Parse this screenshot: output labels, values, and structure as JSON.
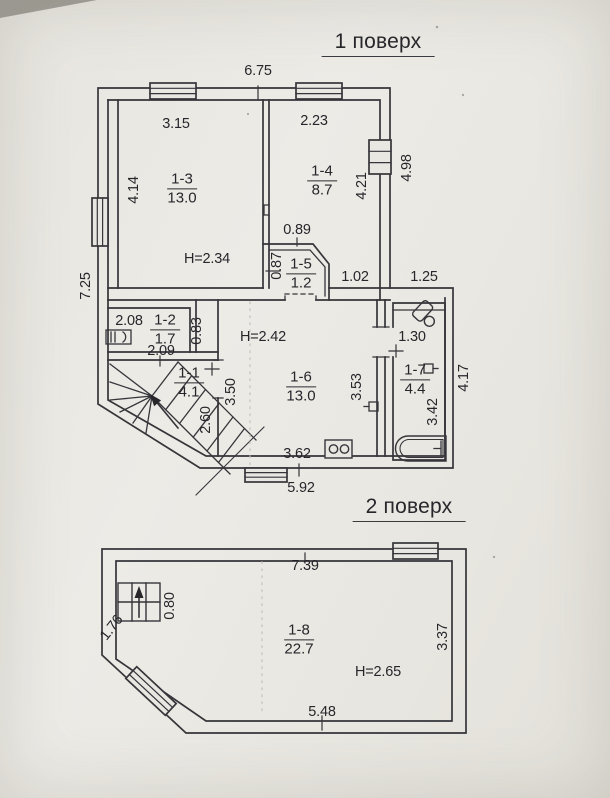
{
  "floor1": {
    "title": "1 поверх",
    "rooms": {
      "r11": {
        "id": "1-1",
        "area": "4.1"
      },
      "r12": {
        "id": "1-2",
        "area": "1.7"
      },
      "r13": {
        "id": "1-3",
        "area": "13.0",
        "height": "H=2.34"
      },
      "r14": {
        "id": "1-4",
        "area": "8.7"
      },
      "r15": {
        "id": "1-5",
        "area": "1.2"
      },
      "r16": {
        "id": "1-6",
        "area": "13.0",
        "height": "H=2.42"
      },
      "r17": {
        "id": "1-7",
        "area": "4.4"
      }
    },
    "dims": {
      "top_width": "6.75",
      "r13_width": "3.15",
      "r14_width": "2.23",
      "r13_height": "4.14",
      "r14_height": "4.21",
      "right_height": "4.98",
      "left_height": "7.25",
      "vest_width": "0.89",
      "vest_height": "0.87",
      "hall_width": "1.02",
      "porch_width": "1.25",
      "r12_width": "2.08",
      "niche_width": "0.83",
      "stair_width": "2.09",
      "r16_height": "3.50",
      "stair_height": "2.60",
      "r16_right_height": "3.53",
      "r17_width": "1.30",
      "r17_height": "3.42",
      "right_lower_height": "4.17",
      "r16_width": "3.62",
      "bottom_width": "5.92"
    }
  },
  "floor2": {
    "title": "2 поверх",
    "rooms": {
      "r18": {
        "id": "1-8",
        "area": "22.7",
        "height": "H=2.65"
      }
    },
    "dims": {
      "top_width": "7.39",
      "stair_width": "0.80",
      "chamfer_length": "1.76",
      "right_height": "3.37",
      "bottom_width": "5.48"
    }
  }
}
